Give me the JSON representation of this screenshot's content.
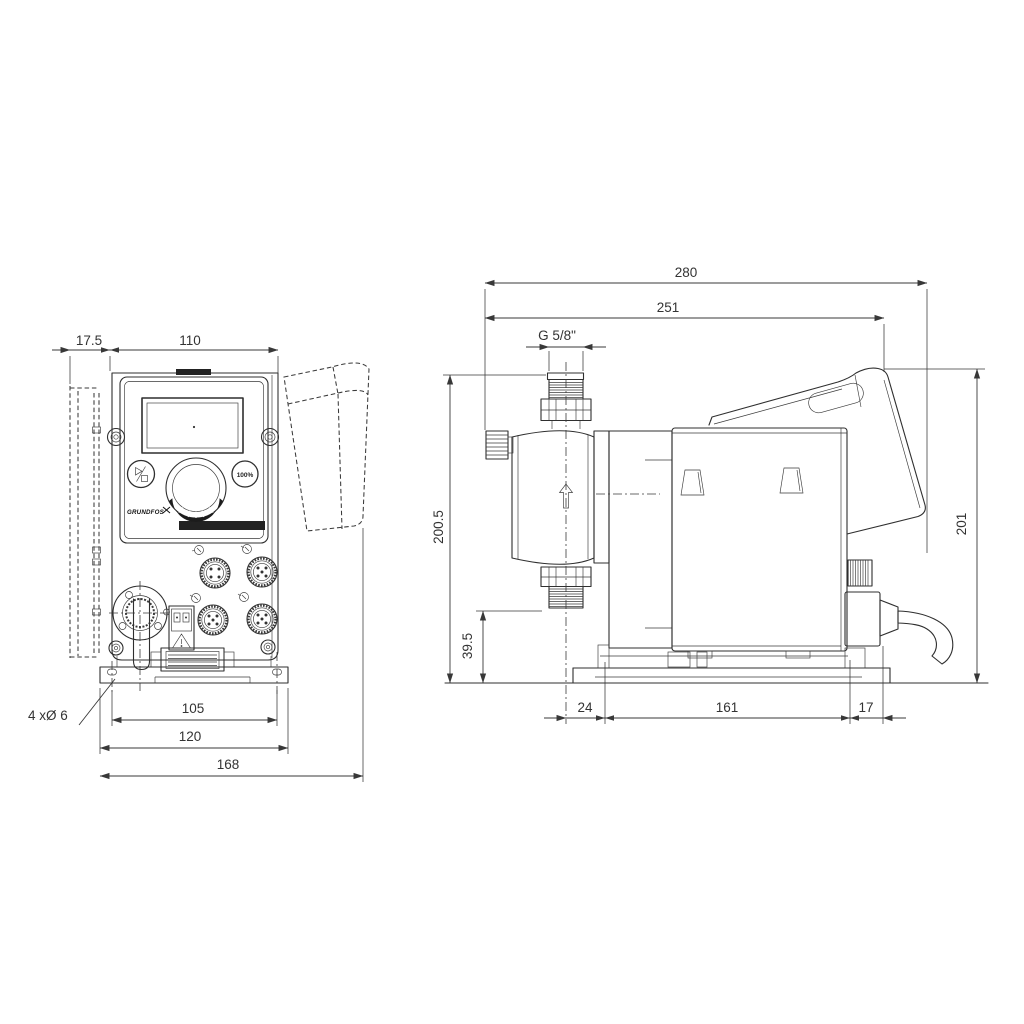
{
  "drawing_type": "dimensional drawing - dosing pump, front and side view",
  "front_view": {
    "dims": {
      "wall_offset": "17.5",
      "body_width": "110",
      "hole_pitch": "105",
      "foot_width": "120",
      "overall_width": "168"
    },
    "labels": {
      "mounting_holes": "4 xØ 6",
      "logo": "GRUNDFOS",
      "button_100": "100%"
    }
  },
  "side_view": {
    "dims": {
      "overall_depth": "280",
      "depth_to_rear_edge": "251",
      "connection_thread": "G 5/8\"",
      "overall_height": "200.5",
      "outlet_height": "39.5",
      "front_overhang": "24",
      "foot_length": "161",
      "rear_overhang": "17",
      "rear_height": "201"
    }
  },
  "colors": {
    "line": "#2f2f2f",
    "dimension": "#383838",
    "background": "#ffffff"
  }
}
